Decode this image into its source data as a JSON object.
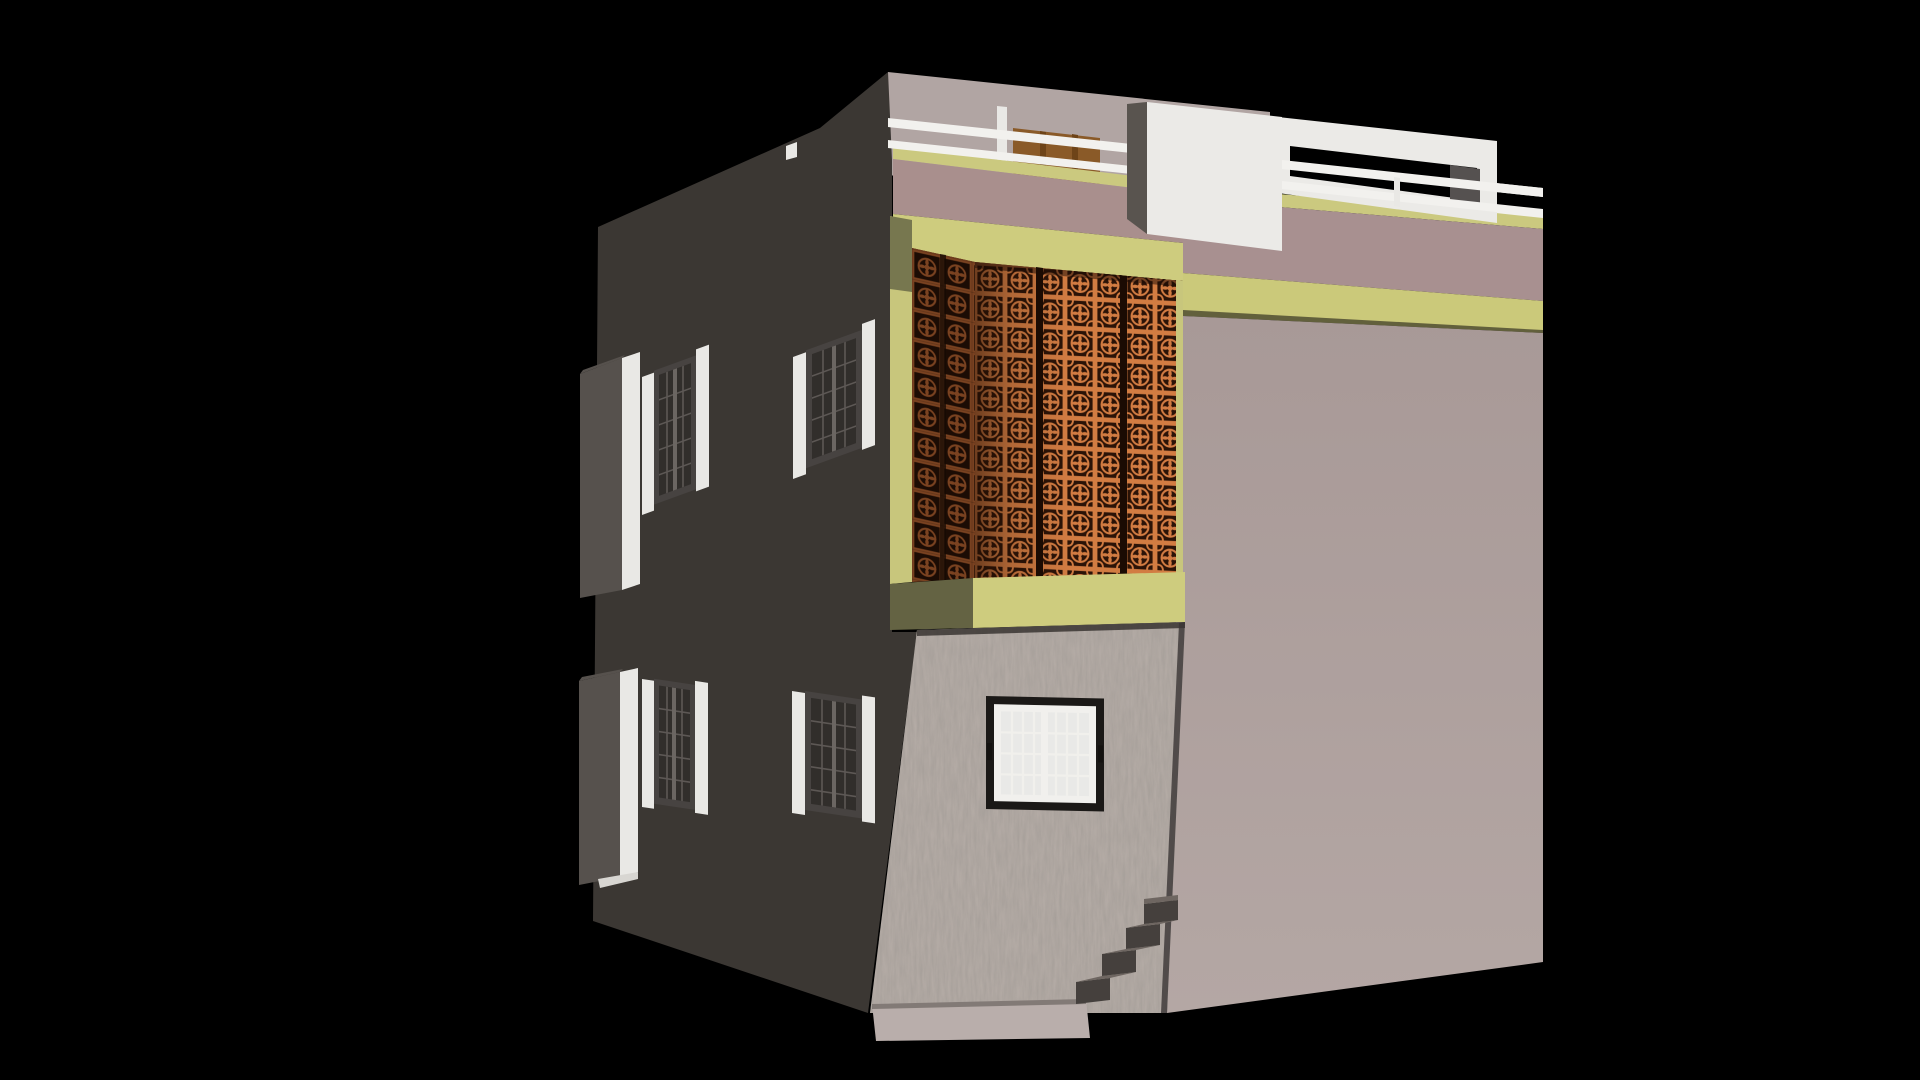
{
  "scene": {
    "type": "3d-architectural-render",
    "description": "Perspective corner view of a two-storey house with rooftop terrace, rendered on a pure black background",
    "visible_parts": [
      "dark side facade with four grilled windows and two projecting wall boxes with white trim",
      "projecting first-floor balcony enclosed by orange perforated jali screen with yellow-green frame bands",
      "rooftop terrace with white pipe railing, white masonry blocks and a brown wooden door",
      "mauve parapet walls with yellow-green coping and floor bands",
      "textured stucco entrance pier with black-framed white sliding window",
      "smooth mauve right facade",
      "concrete entry steps and plinth at the base"
    ]
  },
  "palette": {
    "sky": "#000000",
    "facade_dark": "#3b3733",
    "facade_dark_edge": "#56514d",
    "white_trim": "#e9e8e5",
    "rail_white": "#f2f1ee",
    "roof_wall": "#b1a5a3",
    "roof_block_white": "#ebeae7",
    "roof_block_side": "#59544f",
    "door_brown": "#8a5a28",
    "door_brown_dark": "#6e4418",
    "coping_yellow": "#cbc97f",
    "band_yellow": "#cecc7e",
    "band_yellow_right": "#cbc97a",
    "pilaster_yellow": "#c8c67c",
    "soffit_olive": "#646343",
    "olive_shadow": "#77774f",
    "parapet_mauve": "#a98f8d",
    "parapet_mauve_right": "#a89090",
    "wall_right": "#ab9c9a",
    "jali_orange": "#d27c42",
    "jali_hole_dark": "#2b1307",
    "jali_left_line": "#7a4220",
    "jali_left_bg": "#1c0c04",
    "stucco": "#b6ada7",
    "plinth": "#b9aeab",
    "window_frame_dark": "#474341",
    "window_glass_dark": "#312e2b",
    "window_grid_dark": "#5d5855",
    "front_window_frame": "#1b1917",
    "front_window_sash": "#f1f0ed",
    "front_window_glass": "#e9e9e7",
    "step_tread": "#6e6661",
    "step_riser": "#45403d"
  }
}
